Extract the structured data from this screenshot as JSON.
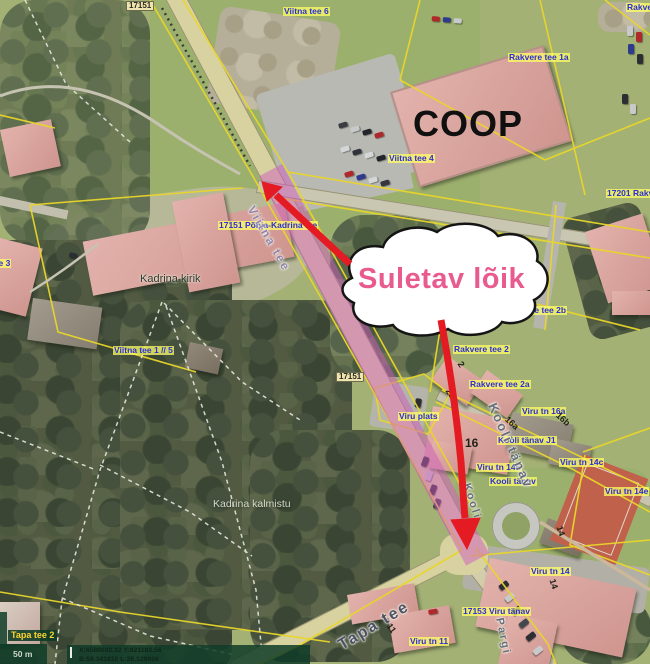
{
  "map": {
    "annotation": {
      "callout_text": "Suletav lõik"
    },
    "labels": [
      {
        "text": "17151",
        "style": "roadbox",
        "x": 126,
        "y": 1
      },
      {
        "text": "Viitna tee 6",
        "style": "blue",
        "x": 283,
        "y": 7
      },
      {
        "text": "Rakve",
        "style": "blue",
        "x": 626,
        "y": 3
      },
      {
        "text": "Rakvere tee 1a",
        "style": "blue",
        "x": 508,
        "y": 53
      },
      {
        "text": "Viitna tee 4",
        "style": "blue",
        "x": 388,
        "y": 154
      },
      {
        "text": "17201 Rakv",
        "style": "blue",
        "x": 606,
        "y": 189
      },
      {
        "text": "17151 Põhja-Kadrina tee",
        "style": "blue",
        "x": 218,
        "y": 221
      },
      {
        "text": "tee 3",
        "style": "blue",
        "x": -10,
        "y": 259
      },
      {
        "text": "Viitna tee 1 // 5",
        "style": "blue",
        "x": 113,
        "y": 346
      },
      {
        "text": "Rakvere tee 2b",
        "style": "blue",
        "x": 505,
        "y": 306
      },
      {
        "text": "Rakvere tee 2",
        "style": "blue",
        "x": 453,
        "y": 345
      },
      {
        "text": "Rakvere tee 2a",
        "style": "blue",
        "x": 469,
        "y": 380
      },
      {
        "text": "Viru tn 16a",
        "style": "blue",
        "x": 521,
        "y": 407
      },
      {
        "text": "Viru plats",
        "style": "blue",
        "x": 398,
        "y": 412
      },
      {
        "text": "Kooli tänav J1",
        "style": "blue",
        "x": 497,
        "y": 436
      },
      {
        "text": "Viru tn 14b",
        "style": "blue",
        "x": 476,
        "y": 463
      },
      {
        "text": "Kooli tänav",
        "style": "blue",
        "x": 489,
        "y": 477
      },
      {
        "text": "Viru tn 14c",
        "style": "blue",
        "x": 559,
        "y": 458
      },
      {
        "text": "Viru tn 14e",
        "style": "blue",
        "x": 604,
        "y": 487
      },
      {
        "text": "Viru tn 14",
        "style": "blue",
        "x": 530,
        "y": 567
      },
      {
        "text": "17153 Viru tänav",
        "style": "blue",
        "x": 462,
        "y": 607
      },
      {
        "text": "Viru tn 11",
        "style": "blue",
        "x": 409,
        "y": 637
      },
      {
        "text": "Tapa tee 2",
        "style": "yellowgreen",
        "x": 8,
        "y": 630
      },
      {
        "text": "Kadrina kirik",
        "style": "dark",
        "x": 140,
        "y": 274
      },
      {
        "text": "Kadrina kalmistu",
        "style": "light",
        "x": 213,
        "y": 499
      },
      {
        "text": "Viitna tee",
        "style": "roadname",
        "x": 256,
        "y": 204,
        "rot": 60,
        "size": 12,
        "color": "#9484ad"
      },
      {
        "text": "Tapa tee",
        "style": "roadname",
        "x": 336,
        "y": 640,
        "rot": -31,
        "size": 16,
        "color": "#4c5264"
      },
      {
        "text": "Kooli tänav",
        "style": "roadname",
        "x": 498,
        "y": 401,
        "rot": 66,
        "size": 13
      },
      {
        "text": "Kooli",
        "style": "roadname",
        "x": 471,
        "y": 482,
        "rot": 72,
        "size": 11
      },
      {
        "text": "Pargi",
        "style": "roadname",
        "x": 504,
        "y": 617,
        "rot": 78,
        "size": 11
      },
      {
        "text": "17151",
        "style": "roadbox",
        "x": 336,
        "y": 372
      },
      {
        "text": "2",
        "style": "parcel",
        "x": 463,
        "y": 360,
        "rot": 55
      },
      {
        "text": "2a",
        "style": "parcel",
        "x": 451,
        "y": 387,
        "rot": 55
      },
      {
        "text": "16a",
        "style": "parcel",
        "x": 509,
        "y": 415,
        "rot": 42
      },
      {
        "text": "16b",
        "style": "parcel",
        "x": 560,
        "y": 411,
        "rot": 42
      },
      {
        "text": "16",
        "style": "parcel",
        "x": 465,
        "y": 437,
        "size": 12
      },
      {
        "text": "14",
        "style": "parcel",
        "x": 563,
        "y": 525,
        "rot": 72
      },
      {
        "text": "14",
        "style": "parcel",
        "x": 556,
        "y": 578,
        "rot": 72
      },
      {
        "text": "11",
        "style": "parcel",
        "x": 392,
        "y": 622,
        "rot": 55
      },
      {
        "text": "COOP",
        "style": "coop",
        "x": 413,
        "y": 106
      }
    ]
  },
  "scalebar": {
    "distance": "50 m"
  },
  "statusbar": {
    "line1": "X:6580082.32 Y:621183.56",
    "line2": "B:59.341810 L:26.129926"
  },
  "colors": {
    "label_blue": "#2b2fd4",
    "label_bg": "rgba(255,255,100,0.75)",
    "cadastral": "#e9d62a",
    "closure": "rgba(208,92,192,0.5)",
    "arrow": "#e51b24",
    "annotation_pink": "#e95b8e",
    "bar_bg": "rgba(15,60,40,0.85)"
  }
}
